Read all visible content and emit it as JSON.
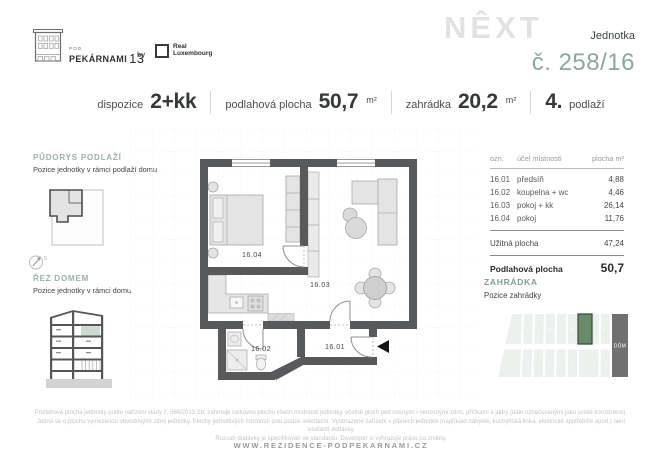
{
  "brand": {
    "building_name_small": "POD",
    "building_name": "PEKÁRNAMI",
    "building_number": "13",
    "by": "by",
    "partner_name_line1": "Real",
    "partner_name_line2": "Luxembourg",
    "watermark": "NÊXT"
  },
  "unit": {
    "label": "Jednotka",
    "number": "č. 258/16"
  },
  "summary": {
    "dispozice": {
      "label": "dispozice",
      "value": "2+kk"
    },
    "podlahova": {
      "label": "podlahová plocha",
      "value": "50,7",
      "unit": "m²"
    },
    "zahradka": {
      "label": "zahrádka",
      "value": "20,2",
      "unit": "m²"
    },
    "podlazi": {
      "value": "4.",
      "label": "podlaží"
    }
  },
  "sidebar": {
    "floorplan": {
      "title": "PŮDORYS PODLAŽÍ",
      "subtitle": "Pozice jednotky v rámci podlaží domu"
    },
    "compass_label": "S",
    "section": {
      "title": "ŘEZ DOMEM",
      "subtitle": "Pozice jednotky v rámci domu"
    }
  },
  "plan": {
    "room_labels": [
      "16.04",
      "16.03",
      "16.02",
      "16.01"
    ]
  },
  "room_table": {
    "headers": [
      "ozn.",
      "účel místnosti",
      "plocha m²"
    ],
    "rows": [
      {
        "code": "16.01",
        "name": "předsíň",
        "area": "4,88"
      },
      {
        "code": "16.02",
        "name": "koupelna + wc",
        "area": "4,46"
      },
      {
        "code": "16.03",
        "name": "pokoj + kk",
        "area": "26,14"
      },
      {
        "code": "16.04",
        "name": "pokoj",
        "area": "11,76"
      }
    ],
    "usable": {
      "label": "Užitná plocha",
      "value": "47,24"
    },
    "total": {
      "label": "Podlahová plocha",
      "value": "50,7"
    }
  },
  "garden": {
    "title": "ZAHRÁDKA",
    "subtitle": "Pozice zahrádky",
    "house_label": "DŮM"
  },
  "footer": {
    "disclaimer_line1": "Podlahová plocha jednotky podle nařízení vlády č. 366/2013 Sb. zahrnuje celkovou plochu všech místností jednotky, včetně ploch pod nosnými i nenosnými zdmi, příčkami a jádry (dále označovanými jako svislé konstrukce).",
    "disclaimer_line2": "Jedná se o plochu vymezenou obvodovými zdmi jednotky. Plochy jednotlivých místností jsou pouze orientační. Vyobrazené zařízení v plánech jednotek (například nábytek, kuchyňská linka, elektrické spotřebiče apod.) není součástí dodávky.",
    "disclaimer_line3": "Rozsah dodávky je specifikován ve standardu. Developer si vyhrazuje právo na změny.",
    "website": "WWW.REZIDENCE-PODPEKARNAMI.CZ"
  },
  "colors": {
    "accent_green": "#8CA89A",
    "wall_gray": "#58595B",
    "garden_green": "#6A8A6C",
    "text_dark": "#3E4543"
  }
}
